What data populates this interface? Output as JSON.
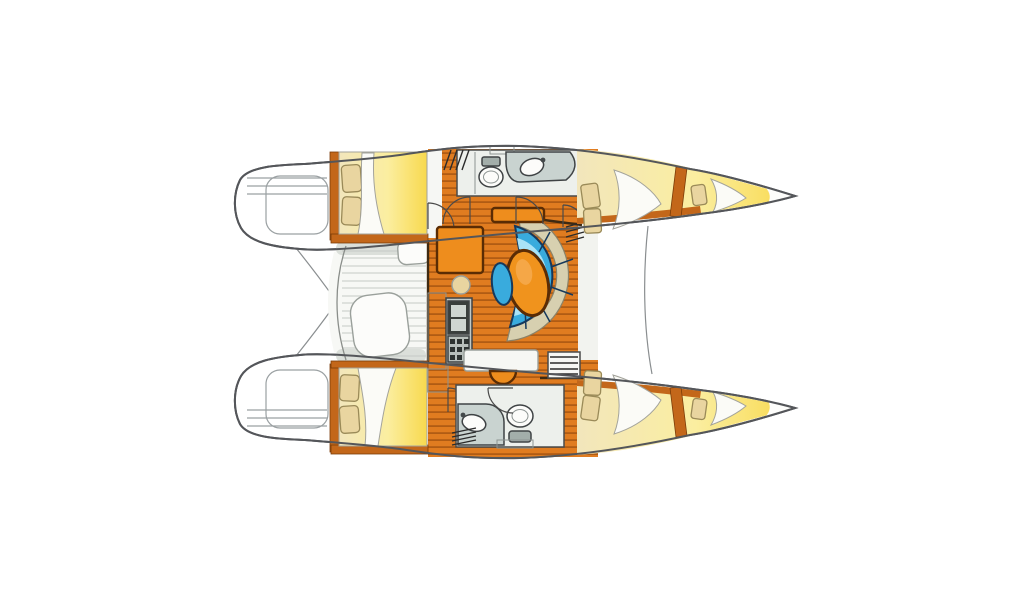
{
  "background": "#ffffff",
  "colors": {
    "hull_fill": "#ffffff",
    "deck_white": "#fdfdfb",
    "walkway": "#f2f3ef",
    "cockpit_floor": "#f7f8f5",
    "bench_gray": "#dbdfda",
    "cushion_white": "#fcfcfa",
    "wood_base": "#e07c20",
    "wood_stripe": "#b05c14",
    "wood_trim": "#c3671a",
    "furniture_orange": "#ee8d1d",
    "table_orange": "#f0931d",
    "table_highlight": "#f8b25e",
    "bed_cream": "#f2e6bc",
    "bed_yellow": "#f8d94e",
    "pillow_fill": "#e9d5a0",
    "linen_white": "#fbfbf7",
    "sofa_blue": "#39abdd",
    "sofa_blue_light": "#a9e3f7",
    "surround_beige": "#d7d0b0",
    "head_floor": "#edf0ec",
    "counter_gray": "#c9d3d0",
    "porcelain": "#fcfcfa",
    "tank_gray": "#a3aeaa",
    "galley_panel": "#c2c9c5",
    "sink_frame": "#3a3f3d",
    "sink_basin": "#cfd6d2",
    "stove_base": "#b8bfbb",
    "burner_dark": "#2e3331",
    "hatch_white": "#f6f7f4"
  }
}
